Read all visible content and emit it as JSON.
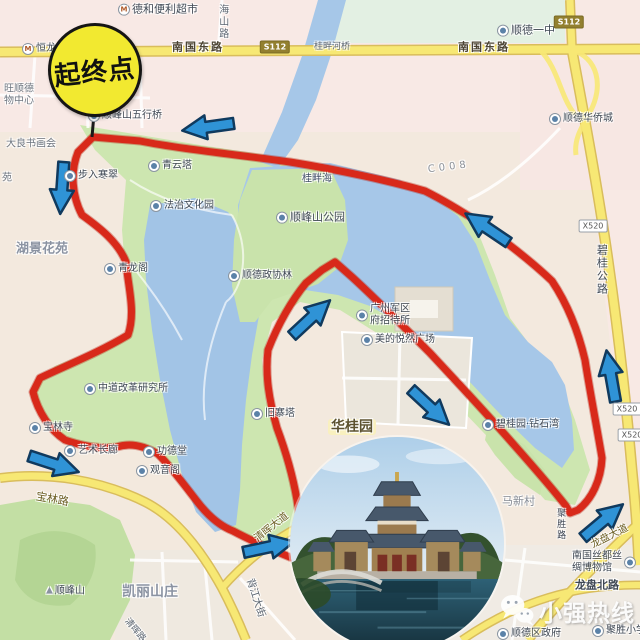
{
  "map": {
    "start_marker": {
      "label": "起终点"
    },
    "watermark": {
      "brand": "小强热线",
      "icon": "wechat-icon"
    },
    "colors": {
      "route": "#d8291a",
      "route_edge": "#b21608",
      "arrow_fill": "#2f93d6",
      "arrow_outline": "#103a5e",
      "start_circle_fill": "#f2e930",
      "water": "#a6c7e8",
      "park_green": "#cde6b0",
      "road_yellow": "#f7e874"
    },
    "badges": [
      {
        "text": "S112",
        "x": 275,
        "y": 47,
        "kind": "provincial"
      },
      {
        "text": "S112",
        "x": 569,
        "y": 22,
        "kind": "provincial"
      },
      {
        "text": "X520",
        "x": 593,
        "y": 226,
        "kind": "county"
      },
      {
        "text": "X520",
        "x": 627,
        "y": 409,
        "kind": "county"
      },
      {
        "text": "X520",
        "x": 632,
        "y": 435,
        "kind": "county"
      }
    ],
    "labels": [
      {
        "text": "德和便利超市",
        "x": 118,
        "y": 10,
        "size": 11,
        "icon": "store-icon"
      },
      {
        "text": "海山路",
        "x": 222,
        "y": 4,
        "size": 10,
        "vertical": true,
        "color": "#5a6470"
      },
      {
        "text": "南国东路",
        "x": 172,
        "y": 48,
        "size": 11,
        "color": "#4c4433",
        "spacing": 2,
        "bold": true
      },
      {
        "text": "桂畔河桥",
        "x": 314,
        "y": 47,
        "size": 9,
        "color": "#5a6470"
      },
      {
        "text": "南国东路",
        "x": 458,
        "y": 48,
        "size": 11,
        "color": "#4c4433",
        "spacing": 2,
        "bold": true
      },
      {
        "text": "顺德一中",
        "x": 497,
        "y": 31,
        "size": 11,
        "icon": "school-icon"
      },
      {
        "text": "恒龙",
        "x": 22,
        "y": 49,
        "size": 10,
        "icon": "metro-icon"
      },
      {
        "text": "旺顺德",
        "x": 4,
        "y": 89,
        "size": 10,
        "color": "#6e7680"
      },
      {
        "text": "物中心",
        "x": 4,
        "y": 101,
        "size": 10,
        "color": "#6e7680"
      },
      {
        "text": "顺德华侨城",
        "x": 549,
        "y": 119,
        "size": 10,
        "icon": "poi-icon"
      },
      {
        "text": "顺峰山五行桥",
        "x": 88,
        "y": 116,
        "size": 10,
        "icon": "bridge-icon"
      },
      {
        "text": "大良书画会",
        "x": 6,
        "y": 144,
        "size": 10,
        "color": "#6e7680"
      },
      {
        "text": "苑",
        "x": 2,
        "y": 178,
        "size": 10,
        "color": "#6e7680"
      },
      {
        "text": "步入寒翠",
        "x": 64,
        "y": 176,
        "size": 10,
        "icon": "poi-icon"
      },
      {
        "text": "青云塔",
        "x": 148,
        "y": 166,
        "size": 10,
        "icon": "pagoda-icon"
      },
      {
        "text": "法治文化园",
        "x": 150,
        "y": 206,
        "size": 10,
        "icon": "poi-icon"
      },
      {
        "text": "湖景花苑",
        "x": 16,
        "y": 250,
        "size": 13,
        "bold": true,
        "color": "#8b93a2"
      },
      {
        "text": "青龙阁",
        "x": 104,
        "y": 269,
        "size": 10,
        "icon": "poi-icon"
      },
      {
        "text": "桂畔海",
        "x": 302,
        "y": 179,
        "size": 10,
        "color": "#44506a"
      },
      {
        "text": "顺峰山公园",
        "x": 276,
        "y": 218,
        "size": 11,
        "icon": "park-icon"
      },
      {
        "text": "顺德政协林",
        "x": 228,
        "y": 276,
        "size": 10,
        "icon": "poi-icon"
      },
      {
        "text": "C008",
        "x": 428,
        "y": 170,
        "size": 10,
        "color": "#8a9098",
        "spacing": 4,
        "rotate": -7
      },
      {
        "text": "碧桂公路",
        "x": 601,
        "y": 244,
        "size": 11,
        "vertical": true,
        "color": "#3f4854"
      },
      {
        "text": "广州军区\n府招待所",
        "x": 356,
        "y": 315,
        "size": 10,
        "icon": "hotel-icon"
      },
      {
        "text": "美的悦然广场",
        "x": 361,
        "y": 340,
        "size": 10,
        "icon": "poi-icon"
      },
      {
        "text": "中道改革研究所",
        "x": 84,
        "y": 389,
        "size": 10,
        "icon": "poi-icon"
      },
      {
        "text": "旧寨塔",
        "x": 251,
        "y": 414,
        "size": 10,
        "icon": "pagoda-icon"
      },
      {
        "text": "华桂园",
        "x": 328,
        "y": 427,
        "size": 14,
        "bold": true,
        "color": "#5c5230",
        "bg": "#f9f0bf"
      },
      {
        "text": "碧桂园·钻石湾",
        "x": 482,
        "y": 425,
        "size": 10,
        "icon": "poi-icon"
      },
      {
        "text": "宝林寺",
        "x": 29,
        "y": 428,
        "size": 10,
        "icon": "temple-icon"
      },
      {
        "text": "艺术长廊",
        "x": 64,
        "y": 451,
        "size": 10,
        "icon": "poi-icon"
      },
      {
        "text": "功德堂",
        "x": 143,
        "y": 452,
        "size": 10,
        "icon": "temple-icon"
      },
      {
        "text": "观音阁",
        "x": 136,
        "y": 471,
        "size": 10,
        "icon": "poi-icon"
      },
      {
        "text": "宝林路",
        "x": 36,
        "y": 497,
        "size": 11,
        "rotate": 10,
        "color": "#6b5d22"
      },
      {
        "text": "马新村",
        "x": 502,
        "y": 502,
        "size": 11,
        "color": "#858b95"
      },
      {
        "text": "聚胜路",
        "x": 560,
        "y": 508,
        "size": 9,
        "vertical": true,
        "color": "#3a4250"
      },
      {
        "text": "清晖大道",
        "x": 256,
        "y": 540,
        "size": 10,
        "rotate": -38,
        "color": "#6b5d22"
      },
      {
        "text": "龙盘大道",
        "x": 592,
        "y": 546,
        "size": 10,
        "rotate": -27,
        "color": "#6b5d22"
      },
      {
        "text": "南国丝都丝\n绸博物馆",
        "x": 572,
        "y": 562,
        "size": 10,
        "icon": "museum-icon",
        "iconSide": "right"
      },
      {
        "text": "龙盘北路",
        "x": 575,
        "y": 586,
        "size": 11,
        "bold": true,
        "color": "#3f4854"
      },
      {
        "text": "背江大街",
        "x": 249,
        "y": 579,
        "size": 10,
        "rotate": 72,
        "color": "#5a6470"
      },
      {
        "text": "凯丽山庄",
        "x": 122,
        "y": 592,
        "size": 14,
        "bold": true,
        "color": "#8b93a2"
      },
      {
        "text": "顺峰山",
        "x": 46,
        "y": 591,
        "size": 10,
        "icon": "mountain-icon"
      },
      {
        "text": "清晖路",
        "x": 126,
        "y": 620,
        "size": 9,
        "rotate": 50,
        "color": "#5a6470"
      },
      {
        "text": "顺德区政府",
        "x": 497,
        "y": 634,
        "size": 10,
        "icon": "gov-icon"
      },
      {
        "text": "聚胜小学",
        "x": 592,
        "y": 631,
        "size": 10,
        "icon": "school-icon"
      }
    ],
    "arrows": [
      {
        "x": 208,
        "y": 127,
        "angle": 172
      },
      {
        "x": 487,
        "y": 228,
        "angle": 214
      },
      {
        "x": 62,
        "y": 188,
        "angle": 94
      },
      {
        "x": 54,
        "y": 464,
        "angle": 18
      },
      {
        "x": 311,
        "y": 318,
        "angle": -43
      },
      {
        "x": 430,
        "y": 407,
        "angle": 43
      },
      {
        "x": 611,
        "y": 376,
        "angle": -100
      },
      {
        "x": 603,
        "y": 521,
        "angle": -40
      },
      {
        "x": 269,
        "y": 547,
        "angle": -12
      }
    ]
  }
}
